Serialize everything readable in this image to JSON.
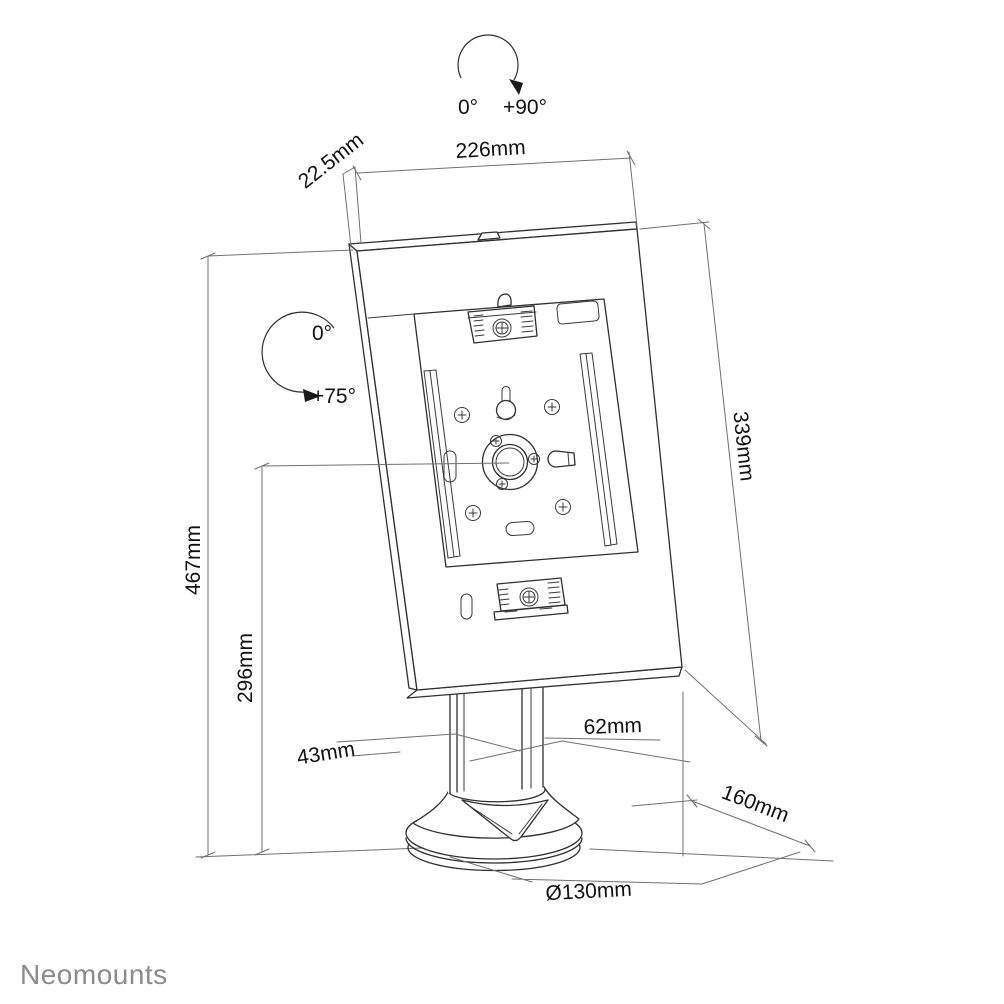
{
  "page": {
    "background": "#ffffff"
  },
  "logo": {
    "text": "Neomounts",
    "color": "#8b8b8b"
  },
  "annotations": {
    "rotation_arc": {
      "start": "0°",
      "end": "+90°"
    },
    "tilt_arc": {
      "start": "0°",
      "end": "+75°"
    }
  },
  "dimensions": {
    "enclosure_width": "226mm",
    "enclosure_thickness": "22.5mm",
    "enclosure_height": "339mm",
    "total_height": "467mm",
    "hub_center_height": "296mm",
    "pole_width": "43mm",
    "pole_depth": "62mm",
    "base_depth": "160mm",
    "base_diameter": "Ø130mm"
  },
  "drawing_colors": {
    "object_stroke": "#2f2f2f",
    "dimension_stroke": "#707070",
    "text": "#111111"
  }
}
